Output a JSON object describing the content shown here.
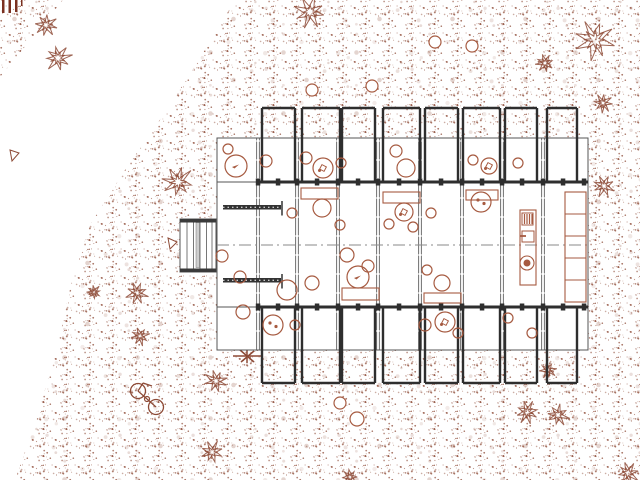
{
  "colors": {
    "ink": "#8d4a36",
    "furniture": "#a65a40",
    "wall_dark": "#2e2e2e",
    "wall_mid": "#555555",
    "grid": "#6f6f6f",
    "center_line": "#8a8a8a",
    "deck_cap": "#3a3a3a",
    "background": "#ffffff",
    "corner_marks": "#7a3020"
  },
  "canvas": {
    "width": 640,
    "height": 480
  },
  "terrain": {
    "clearing_polygon": [
      [
        63,
        0
      ],
      [
        235,
        0
      ],
      [
        205,
        50
      ],
      [
        170,
        105
      ],
      [
        125,
        170
      ],
      [
        90,
        225
      ],
      [
        72,
        280
      ],
      [
        60,
        335
      ],
      [
        38,
        415
      ],
      [
        15,
        480
      ],
      [
        0,
        480
      ],
      [
        0,
        77
      ]
    ]
  },
  "building": {
    "body": {
      "x": 217,
      "y": 138,
      "w": 371,
      "h": 212
    },
    "bays_x": [
      [
        262,
        295
      ],
      [
        302,
        340
      ],
      [
        342,
        375
      ],
      [
        383,
        420
      ],
      [
        425,
        458
      ],
      [
        463,
        500
      ],
      [
        505,
        537
      ],
      [
        547,
        577
      ]
    ],
    "top_bay": {
      "top": 108,
      "wall_end": 182
    },
    "bottom_bay": {
      "start": 307,
      "bottom": 383
    },
    "h_lines": {
      "roof_top": 138,
      "band_top": 182,
      "center": 245,
      "band_bottom": 307,
      "base": 350
    },
    "grid_x": [
      258,
      297,
      338,
      378,
      420,
      462,
      502,
      543
    ],
    "columns_x": [
      258,
      278,
      297,
      317,
      338,
      358,
      378,
      399,
      420,
      441,
      462,
      482,
      502,
      522,
      543,
      563,
      584
    ],
    "hatch_bars": [
      {
        "x": 223,
        "y": 205,
        "w": 58,
        "h": 4.5
      },
      {
        "x": 223,
        "y": 278,
        "w": 58,
        "h": 4.5
      }
    ],
    "deck": {
      "x": 180,
      "y": 219,
      "w": 36,
      "h": 53
    }
  },
  "furniture": [
    {
      "t": "circle",
      "x": 236,
      "y": 166,
      "r": 11,
      "g": "bird"
    },
    {
      "t": "blob",
      "x": 266,
      "y": 161,
      "r": 6
    },
    {
      "t": "blob",
      "x": 228,
      "y": 149,
      "r": 5
    },
    {
      "t": "blob",
      "x": 306,
      "y": 158,
      "r": 6
    },
    {
      "t": "circle",
      "x": 323,
      "y": 168,
      "r": 10,
      "g": "square"
    },
    {
      "t": "blob",
      "x": 341,
      "y": 163,
      "r": 5
    },
    {
      "t": "blob",
      "x": 396,
      "y": 151,
      "r": 6
    },
    {
      "t": "circle",
      "x": 406,
      "y": 168,
      "r": 9
    },
    {
      "t": "blob",
      "x": 473,
      "y": 160,
      "r": 5
    },
    {
      "t": "circle",
      "x": 489,
      "y": 166,
      "r": 8,
      "g": "square"
    },
    {
      "t": "blob",
      "x": 518,
      "y": 163,
      "r": 5
    },
    {
      "t": "rect",
      "x": 301,
      "y": 188,
      "w": 37,
      "h": 11
    },
    {
      "t": "circle",
      "x": 322,
      "y": 208,
      "r": 9
    },
    {
      "t": "blob",
      "x": 292,
      "y": 213,
      "r": 5
    },
    {
      "t": "blob",
      "x": 340,
      "y": 225,
      "r": 5
    },
    {
      "t": "rect",
      "x": 383,
      "y": 192,
      "w": 37,
      "h": 11
    },
    {
      "t": "circle",
      "x": 404,
      "y": 212,
      "r": 9,
      "g": "square"
    },
    {
      "t": "blob",
      "x": 389,
      "y": 224,
      "r": 5
    },
    {
      "t": "blob",
      "x": 413,
      "y": 227,
      "r": 5
    },
    {
      "t": "blob",
      "x": 431,
      "y": 213,
      "r": 5
    },
    {
      "t": "rect",
      "x": 466,
      "y": 190,
      "w": 32,
      "h": 10
    },
    {
      "t": "circle",
      "x": 481,
      "y": 202,
      "r": 10,
      "g": "dots"
    },
    {
      "t": "blob",
      "x": 222,
      "y": 256,
      "r": 6
    },
    {
      "t": "blob",
      "x": 240,
      "y": 277,
      "r": 6
    },
    {
      "t": "circle",
      "x": 287,
      "y": 290,
      "r": 10
    },
    {
      "t": "blob",
      "x": 312,
      "y": 283,
      "r": 7
    },
    {
      "t": "circle",
      "x": 347,
      "y": 255,
      "r": 7
    },
    {
      "t": "blob",
      "x": 368,
      "y": 266,
      "r": 6
    },
    {
      "t": "circle",
      "x": 358,
      "y": 277,
      "r": 11,
      "g": "bird"
    },
    {
      "t": "rect",
      "x": 342,
      "y": 288,
      "w": 37,
      "h": 12
    },
    {
      "t": "blob",
      "x": 427,
      "y": 270,
      "r": 5
    },
    {
      "t": "circle",
      "x": 442,
      "y": 283,
      "r": 8
    },
    {
      "t": "rect",
      "x": 424,
      "y": 293,
      "w": 37,
      "h": 10
    },
    {
      "t": "blob",
      "x": 243,
      "y": 312,
      "r": 7
    },
    {
      "t": "circle",
      "x": 273,
      "y": 325,
      "r": 10,
      "g": "dots"
    },
    {
      "t": "blob",
      "x": 295,
      "y": 325,
      "r": 5
    },
    {
      "t": "blob",
      "x": 425,
      "y": 325,
      "r": 6
    },
    {
      "t": "circle",
      "x": 445,
      "y": 322,
      "r": 10,
      "g": "square"
    },
    {
      "t": "blob",
      "x": 458,
      "y": 333,
      "r": 5
    },
    {
      "t": "blob",
      "x": 508,
      "y": 318,
      "r": 5
    },
    {
      "t": "blob",
      "x": 532,
      "y": 333,
      "r": 5
    },
    {
      "t": "kitchen",
      "x": 520,
      "y": 210,
      "w": 16,
      "h": 75
    },
    {
      "t": "shelf",
      "x": 565,
      "y": 192,
      "w": 21,
      "h": 110,
      "cells": 5
    }
  ],
  "site": {
    "trees": [
      [
        46,
        25,
        11
      ],
      [
        58,
        58,
        13
      ],
      [
        310,
        12,
        15
      ],
      [
        595,
        40,
        20
      ],
      [
        545,
        63,
        9
      ],
      [
        603,
        103,
        9
      ],
      [
        604,
        186,
        11
      ],
      [
        178,
        182,
        15
      ],
      [
        137,
        293,
        11
      ],
      [
        94,
        292,
        7
      ],
      [
        140,
        336,
        9
      ],
      [
        216,
        381,
        11
      ],
      [
        212,
        452,
        11
      ],
      [
        527,
        412,
        11
      ],
      [
        558,
        415,
        11
      ],
      [
        628,
        473,
        11
      ],
      [
        548,
        370,
        8
      ],
      [
        350,
        477,
        8
      ]
    ],
    "white_circles": [
      [
        312,
        90,
        6
      ],
      [
        372,
        86,
        6
      ],
      [
        435,
        42,
        6
      ],
      [
        472,
        46,
        6
      ],
      [
        340,
        403,
        6
      ],
      [
        357,
        419,
        7
      ]
    ],
    "bicycle": {
      "wheels": [
        [
          138,
          391,
          7.5
        ],
        [
          156,
          407,
          7.5
        ]
      ],
      "pedal": [
        147,
        399,
        2.5
      ]
    },
    "corner_bars": [
      {
        "x": 2,
        "y": 0,
        "w": 2.5,
        "h": 13
      },
      {
        "x": 8.5,
        "y": 0,
        "w": 2.5,
        "h": 13
      },
      {
        "x": 15,
        "y": 0,
        "w": 2.5,
        "h": 12
      },
      {
        "x": 21,
        "y": 0,
        "w": 1.5,
        "h": 6
      }
    ],
    "triangles": [
      "10,150 19,153 12,161",
      "168,238 177,242 170,249"
    ],
    "cross_marker": {
      "lines": [
        [
          233,
          356,
          262,
          356
        ],
        [
          247,
          349,
          247,
          363
        ],
        [
          240,
          350,
          254,
          362
        ],
        [
          254,
          351,
          241,
          362
        ]
      ]
    }
  }
}
